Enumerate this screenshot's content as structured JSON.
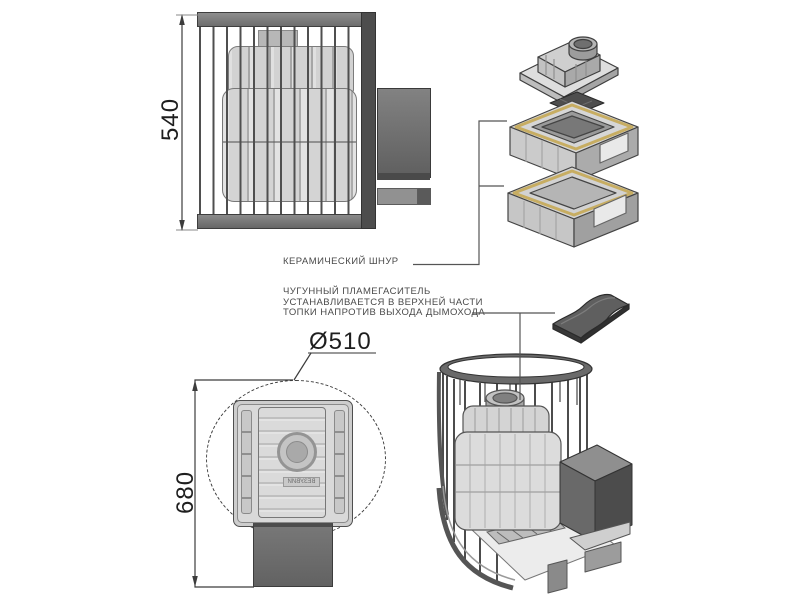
{
  "annotations": {
    "ceramic_cord_label": "КЕРАМИЧЕСКИЙ ШНУР",
    "flame_arrester_note": {
      "line1": "ЧУГУННЫЙ ПЛАМЕГАСИТЕЛЬ",
      "line2": "УСТАНАВЛИВАЕТСЯ В ВЕРХНЕЙ ЧАСТИ",
      "line3": "ТОПКИ НАПРОТИВ ВЫХОДА ДЫМОХОДА"
    }
  },
  "dimensions": {
    "side_height_mm": "540",
    "stone_cage_diameter": "Ø510",
    "overall_height_mm": "680"
  },
  "brand_emboss": "ВЕЗУВИЙ",
  "colors": {
    "background": "#ffffff",
    "line_dark": "#333333",
    "annotation_text": "#4a4a4a",
    "metal_light": "#d8d8d8",
    "metal_mid": "#8a8a8a",
    "metal_dark": "#555555",
    "ceramic_cord_yellow": "#c7ad62"
  }
}
